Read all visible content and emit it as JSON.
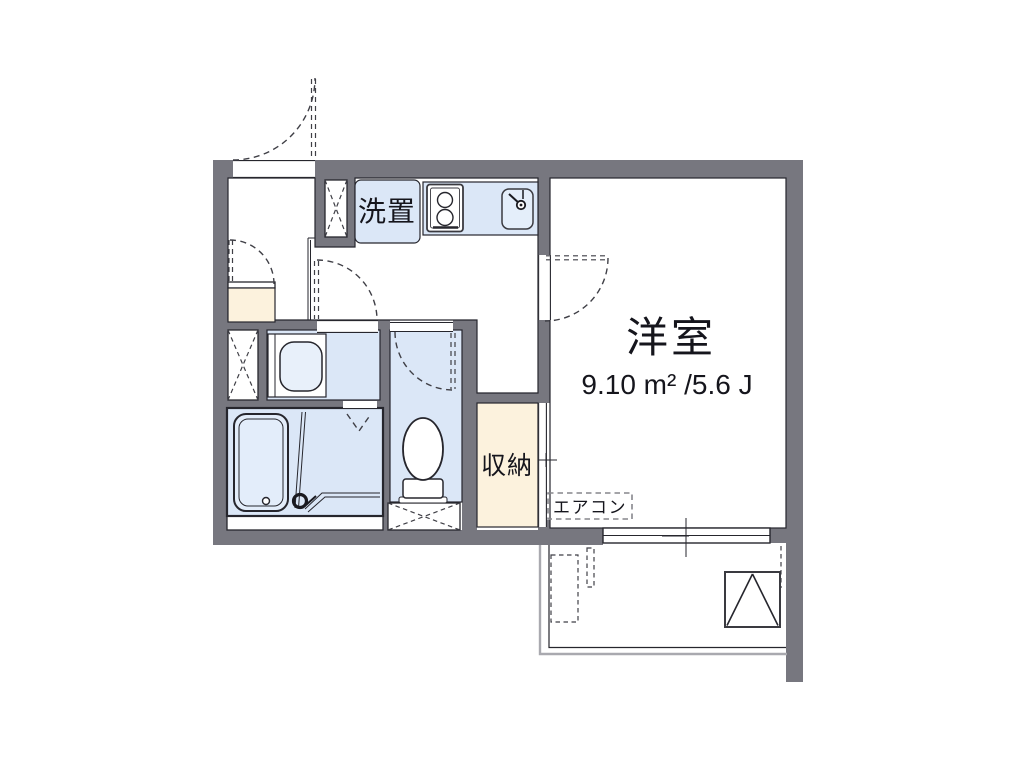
{
  "plan": {
    "type": "japanese-apartment-floor-plan",
    "rooms": {
      "western_room": {
        "label": "洋室",
        "size": "9.10 m² /5.6 J"
      },
      "closet": {
        "label": "収納"
      },
      "washer_place": {
        "label": "洗置"
      },
      "aircon_slot": {
        "label": "エアコン"
      }
    },
    "colors": {
      "wall": "#77777f",
      "water": "#dbe7f7",
      "wood": "#fcf2dd",
      "line": "#26262d",
      "dash": "#3f3f46",
      "light": "#a9a9af",
      "text": "#15151c"
    }
  }
}
